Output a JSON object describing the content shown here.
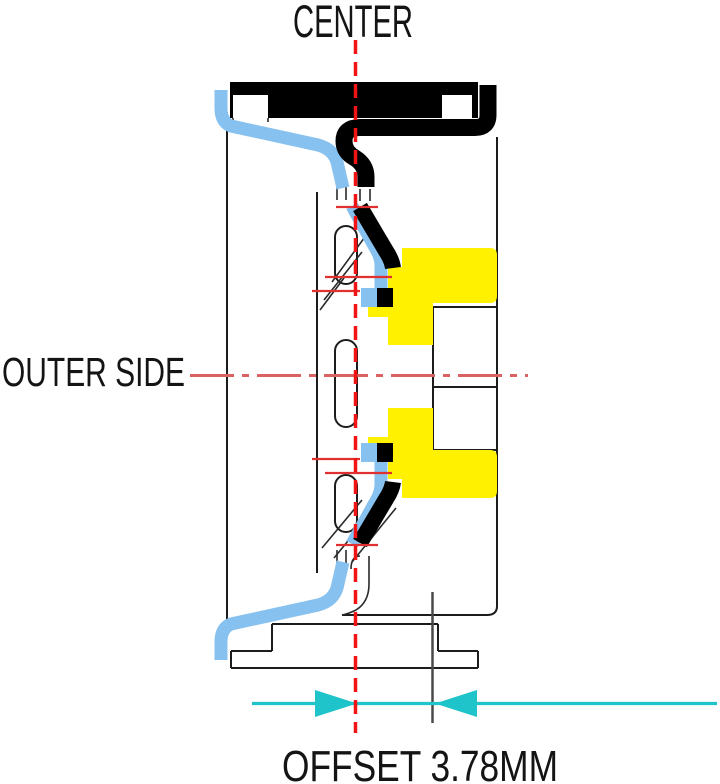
{
  "diagram": {
    "center_label": "CENTER",
    "outer_side_label": "OUTER SIDE",
    "offset_label": "OFFSET 3.78MM",
    "offset_value_mm": "3.78"
  },
  "colors": {
    "background": "#FFFFFF",
    "highlight_yellow": "#FFF100",
    "highlight_blue": "#87C1EF",
    "fill_black": "#000000",
    "line_black": "#1C1C1C",
    "centerline_red": "#F21414",
    "axis_red": "#D96262",
    "tick_red": "#E03030",
    "dimension_cyan": "#1EC4C9",
    "offset_line_gray": "#4A4A4A",
    "text_color": "#141414"
  }
}
